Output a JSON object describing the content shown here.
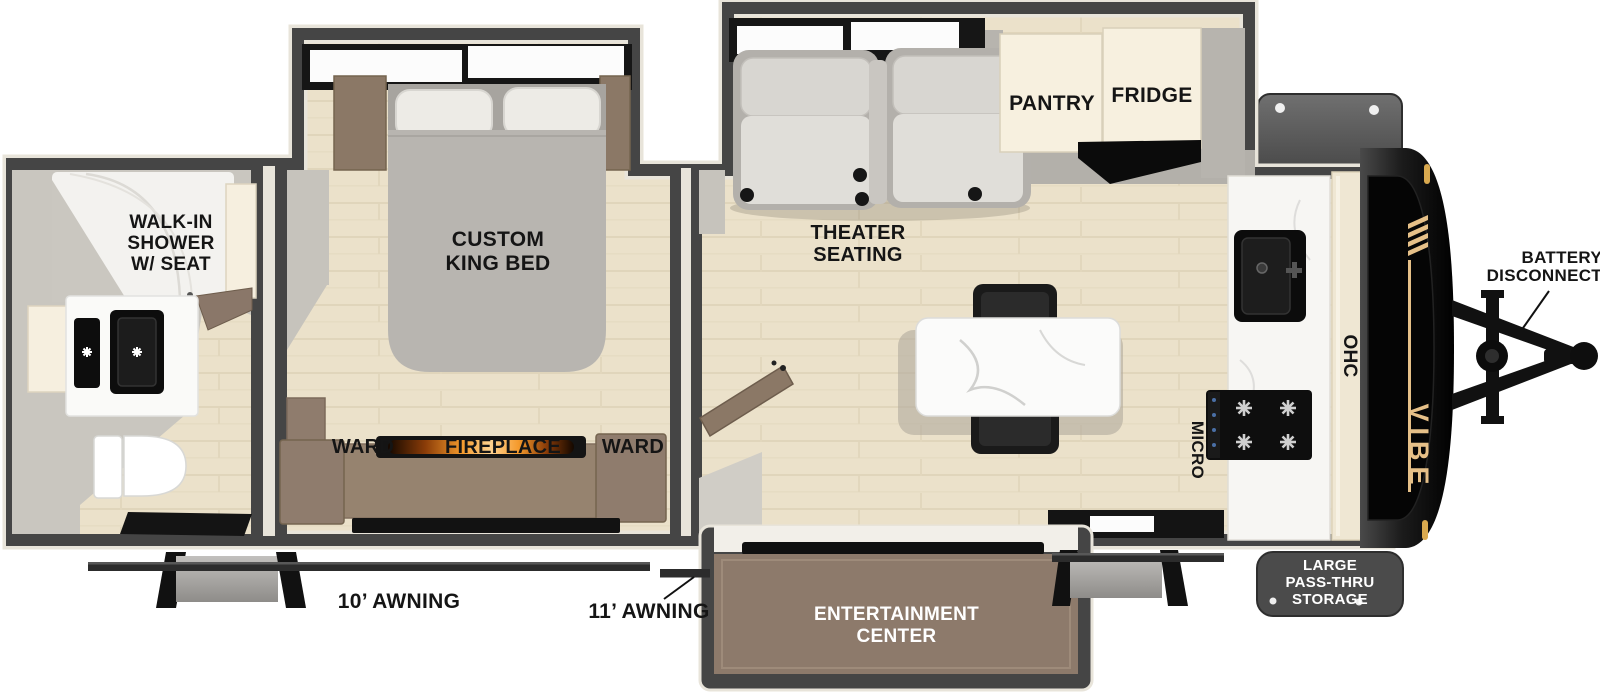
{
  "title": "VIBE travel trailer floor plan",
  "brand": "VIBE",
  "colors": {
    "wall": "#454545",
    "trim": "#e8e4da",
    "floor": "#ebe1ca",
    "cabinet_brown": "#8f7c6d",
    "cabinet_cream": "#f6efdf",
    "counter_white": "#f7f6f3",
    "accent_gold": "#e6c088",
    "label_black": "#151515",
    "label_white": "#ffffff",
    "storage_tab": "#4b4b4b"
  },
  "labels": {
    "walk_in_shower": [
      "WALK-IN",
      "SHOWER",
      "W/ SEAT"
    ],
    "custom_king_bed": [
      "CUSTOM",
      "KING BED"
    ],
    "ward_left": "WARD",
    "fireplace": "FIREPLACE",
    "ward_right": "WARD",
    "theater_seating": [
      "THEATER",
      "SEATING"
    ],
    "pantry": "PANTRY",
    "fridge": "FRIDGE",
    "micro": "MICRO",
    "ohc": "OHC",
    "vibe_logo": "VIBE",
    "battery_disconnect": [
      "BATTERY",
      "DISCONNECT"
    ],
    "large_pass_thru_storage": [
      "LARGE",
      "PASS-THRU",
      "STORAGE"
    ],
    "entertainment_center": [
      "ENTERTAINMENT",
      "CENTER"
    ],
    "awning_left": "10’ AWNING",
    "awning_right": "11’ AWNING"
  }
}
